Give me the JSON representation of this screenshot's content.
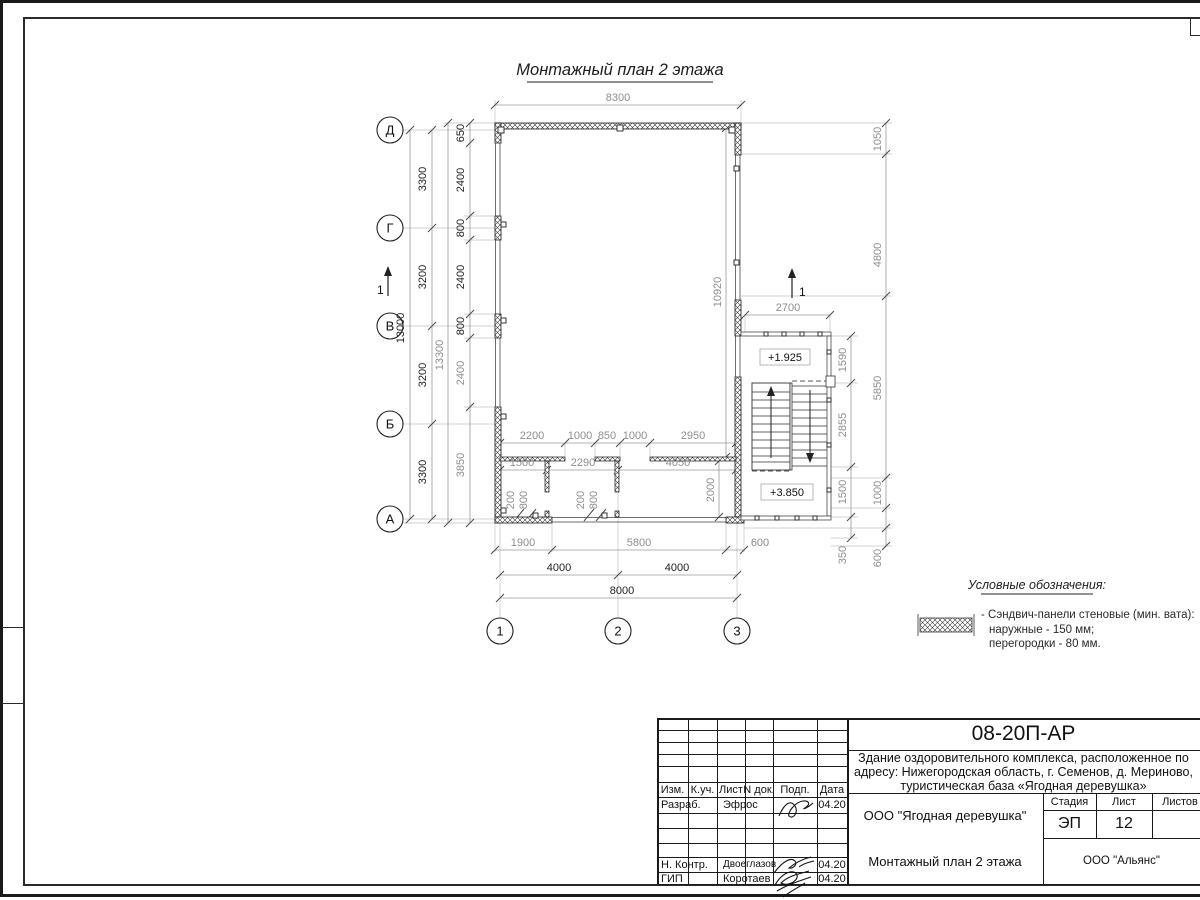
{
  "sheet": {
    "title": "Монтажный план 2 этажа"
  },
  "axes": {
    "rows": [
      "Д",
      "Г",
      "В",
      "Б",
      "А"
    ],
    "cols": [
      "1",
      "2",
      "3"
    ]
  },
  "section_marks": [
    "1",
    "1"
  ],
  "elevations": [
    "+1.925",
    "+3.850"
  ],
  "dims": {
    "top_width": "8300",
    "left_axis": [
      "3300",
      "3200",
      "3200",
      "3300"
    ],
    "left_total": "13000",
    "left_overall": "13300",
    "left_inner": [
      "650",
      "2400",
      "800",
      "2400",
      "800",
      "2400",
      "3850"
    ],
    "interior_height": "10920",
    "right_outer": [
      "1050",
      "4800",
      "5850",
      "1000",
      "600"
    ],
    "right_inner": [
      "1590",
      "2855",
      "1500",
      "350"
    ],
    "stair_width": "2700",
    "room_top": [
      "2200",
      "1000",
      "850",
      "1000",
      "2950"
    ],
    "room_mid": [
      "1500",
      "2290",
      "4050"
    ],
    "door_dims": [
      "200",
      "800",
      "200",
      "800"
    ],
    "wall_gap": "2000",
    "bottom_segments": [
      "1900",
      "5800",
      "600"
    ],
    "bottom_spans": [
      "4000",
      "4000"
    ],
    "bottom_total": "8000"
  },
  "legend": {
    "title": "Условные обозначения:",
    "item_line1": "- Сэндвич-панели стеновые (мин. вата):",
    "item_line2": "наружные - 150 мм;",
    "item_line3": "перегородки - 80 мм."
  },
  "titleblock": {
    "doc_number": "08-20П-АР",
    "desc_line1": "Здание оздоровительного комплекса, расположенное по",
    "desc_line2": "адресу: Нижегородская область, г. Семенов, д. Мериново,",
    "desc_line3": "туристическая база «Ягодная деревушка»",
    "org": "ООО \"Ягодная деревушка\"",
    "sheet_name": "Монтажный план 2 этажа",
    "contractor": "ООО \"Альянс\"",
    "stage_label": "Стадия",
    "sheet_label": "Лист",
    "sheets_label": "Листов",
    "stage_value": "ЭП",
    "sheet_value": "12",
    "header_cols": [
      "Изм.",
      "К.уч.",
      "Лист",
      "N док.",
      "Подп.",
      "Дата"
    ],
    "row_developer_label": "Разраб.",
    "row_developer_name": "Эфрос",
    "row_ncontrol_label": "Н. Контр.",
    "row_ncontrol_name": "Двоеглазов",
    "row_gip_label": "ГИП",
    "row_gip_name": "Коротаев",
    "dates": [
      "04.20",
      "04.20",
      "04.20"
    ]
  }
}
